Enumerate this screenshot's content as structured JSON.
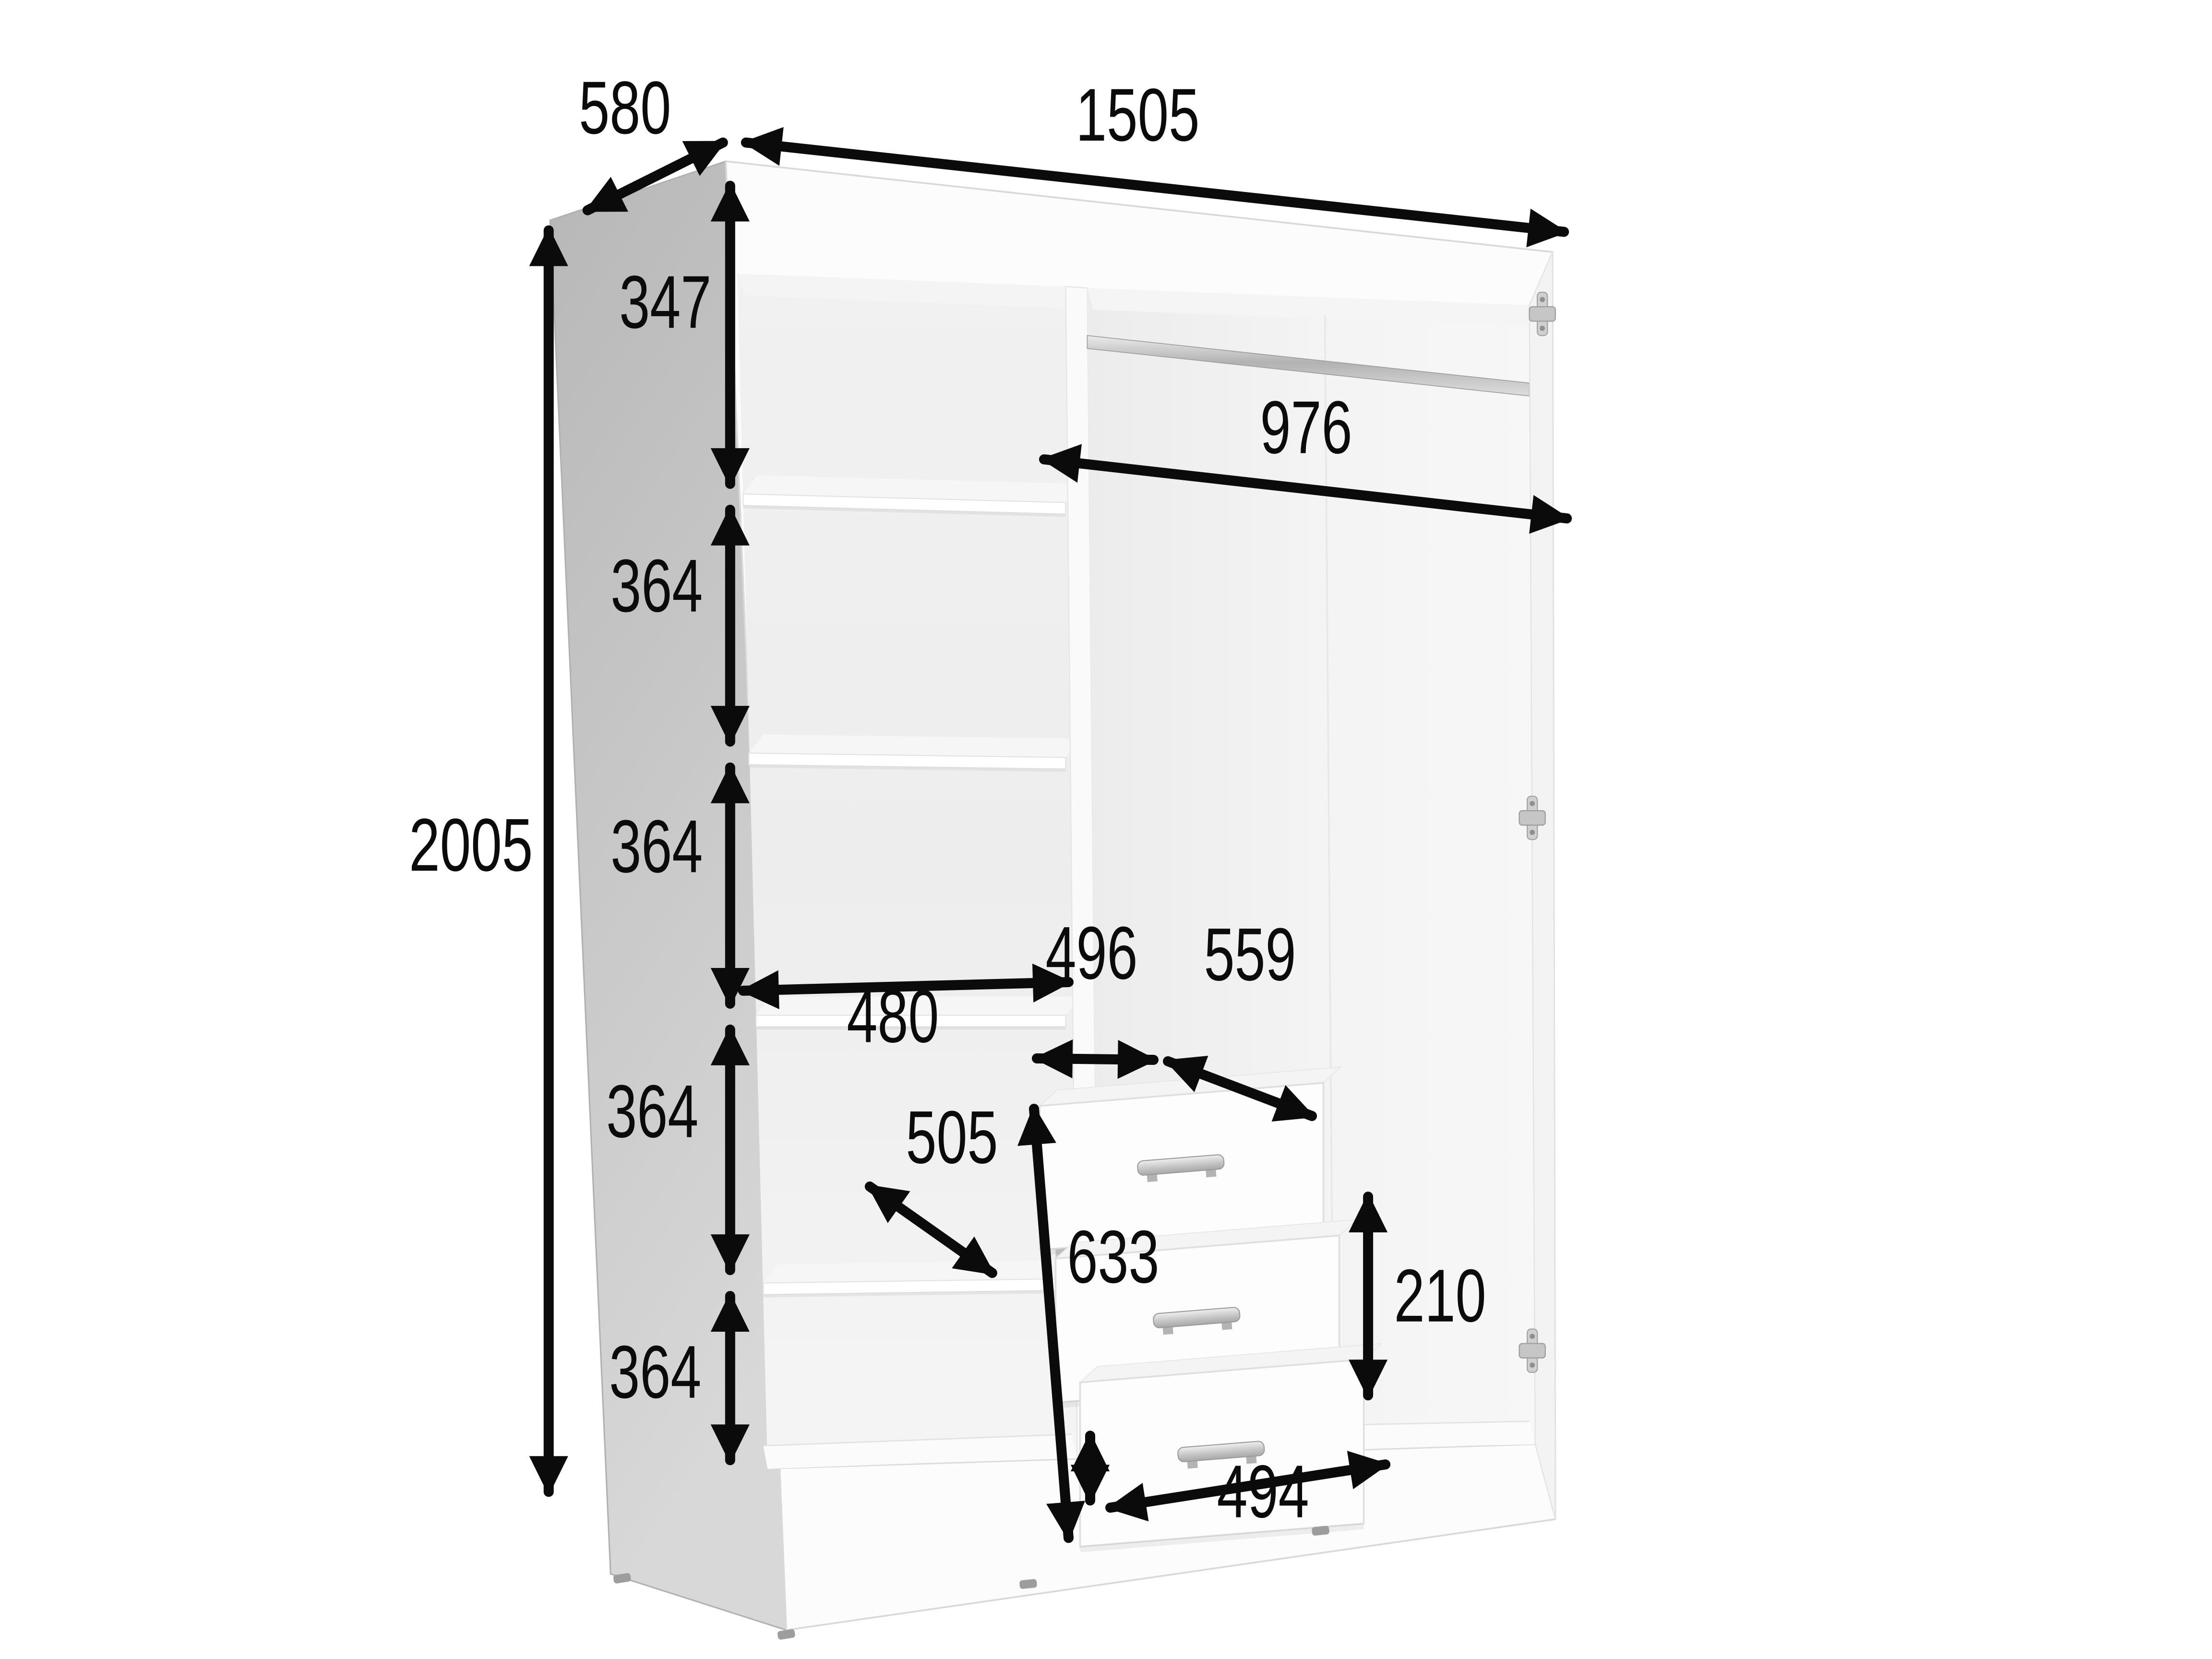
{
  "diagram": {
    "kind": "wardrobe-dimension-diagram",
    "background": "#ffffff"
  },
  "colors": {
    "dimension_ink": "#0b0b0b",
    "side_panel_gray": "#c2c2c2",
    "carcass_white": "#fbfbfb",
    "interior_gray": "#f0f0f0",
    "handle_silver": "#c6c6c6",
    "hinge_silver": "#c9c9c9",
    "rod_chrome": "#bfbfbf"
  },
  "dimensions": {
    "depth": "580",
    "width": "1505",
    "height": "2005",
    "top_shelf_gap": "347",
    "shelf_gaps": [
      "364",
      "364",
      "364",
      "364"
    ],
    "shelf_width": "480",
    "shelf_depth": "505",
    "hanging_section_width": "976",
    "drawer_section_width": "496",
    "side_clearance_width": "559",
    "drawer_stack_height": "633",
    "drawer_height": "210",
    "drawer_front_width": "494"
  }
}
